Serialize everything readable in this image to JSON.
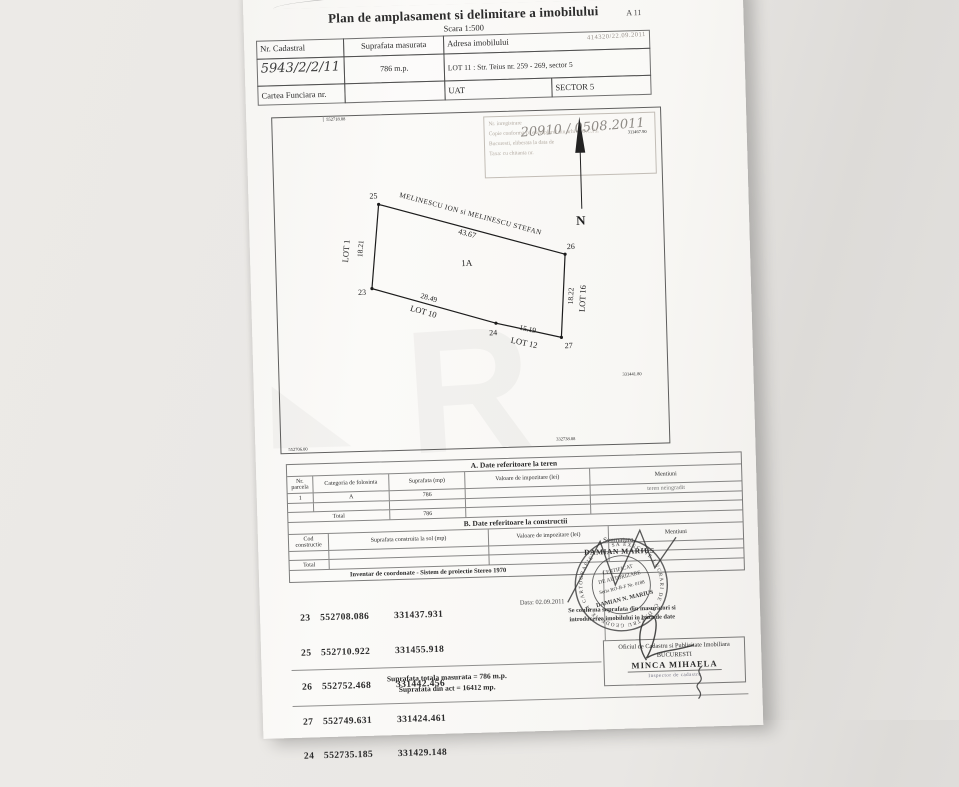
{
  "document": {
    "title": "Plan de amplasament si delimitare a imobilului",
    "scale": "Scara 1:500",
    "sheet_code": "A 11"
  },
  "header": {
    "cadastral_label": "Nr. Cadastral",
    "cadastral_value": "5943/2/2/11",
    "area_label": "Suprafata masurata",
    "area_value": "786 m.p.",
    "address_label": "Adresa imobilului",
    "address_stamp": "414320/22.09.2011",
    "address_value": "LOT 11 : Str. Teius nr. 259 - 269, sector 5",
    "land_book_label": "Cartea Funciara nr.",
    "uat_label": "UAT",
    "sector_value": "SECTOR 5"
  },
  "reception_stamp": {
    "line1_label": "Nr. inregistrare",
    "line1_hand": "20910 / 0508.2011",
    "line2": "Copie conforma cu exemplarul din arhiva O.C.P.I.",
    "line3": "Bucuresti, eliberata la data de",
    "line4": "Taxa:  cu chitanta nr.",
    "line5": "- Scutit -"
  },
  "drawing": {
    "north_label": "N",
    "owner_top": "MELINESCU ION si MELINESCU STEFAN",
    "parcel_label": "1A",
    "top_length": "43.67",
    "left_length": "18.21",
    "left_lot": "LOT 1",
    "bottom_left_length": "28.49",
    "bottom_left_lot": "LOT 10",
    "bottom_right_length": "15.19",
    "bottom_right_lot": "LOT 12",
    "right_length": "18.22",
    "right_lot": "LOT 16",
    "vertices": [
      "25",
      "26",
      "27",
      "24",
      "23"
    ],
    "grid_labels": [
      "552718.08",
      "311467.90",
      "331441.80",
      "552706.00",
      "332738.08"
    ]
  },
  "table_a": {
    "title": "A. Date referitoare la teren",
    "headers": [
      "Nr. parcela",
      "Categoria de folosinta",
      "Suprafata (mp)",
      "Valoare de impozitare (lei)",
      "Mentiuni"
    ],
    "row1": [
      "1",
      "A",
      "786",
      "",
      "teren neingradit"
    ],
    "total_label": "Total",
    "total_value": "786"
  },
  "table_b": {
    "title": "B. Date referitoare la constructii",
    "headers": [
      "Cod constructie",
      "Suprafata construita la sol (mp)",
      "Valoare de impozitare (lei)",
      "Mentiuni"
    ],
    "total_label": "Total"
  },
  "coordinates": {
    "title": "Inventar de coordonate - Sistem de proiectie Stereo 1970",
    "points": [
      [
        "23",
        "552708.086",
        "331437.931"
      ],
      [
        "25",
        "552710.922",
        "331455.918"
      ],
      [
        "26",
        "552752.468",
        "331442.456"
      ],
      [
        "27",
        "552749.631",
        "331424.461"
      ],
      [
        "24",
        "552735.185",
        "331429.148"
      ]
    ]
  },
  "certification": {
    "date": "Data: 02.09.2011",
    "signature_label": "Semnatura,",
    "prepared_name": "DAMIAN MARIUS",
    "stamp_ring_text": "SA EXECUTE LUCRARI DE CADASTRU GEODEZIE SI CARTOGRAFIE",
    "stamp_line1": "CERTIFICAT",
    "stamp_line2": "DE AUTORIZARE",
    "stamp_line3": "Seria RO-B-F Nr. 0188",
    "stamp_line4": "DAMIAN N. MARIUS",
    "confirm_line1": "Se confirma suprafata din masuratori si",
    "confirm_line2": "introducerea imobilului in baza de date"
  },
  "footer": {
    "measured_area": "Suprafata totala masurata = 786 m.p.",
    "act_area": "Suprafata din act = 16412 mp.",
    "office_line1": "Oficiul de Cadastru si Publicitate Imobiliara",
    "office_line2": "BUCURESTI",
    "officer_name": "MINCA MIHAELA",
    "officer_role": "Inspector de cadastru"
  },
  "watermark": {
    "letter": "R"
  }
}
